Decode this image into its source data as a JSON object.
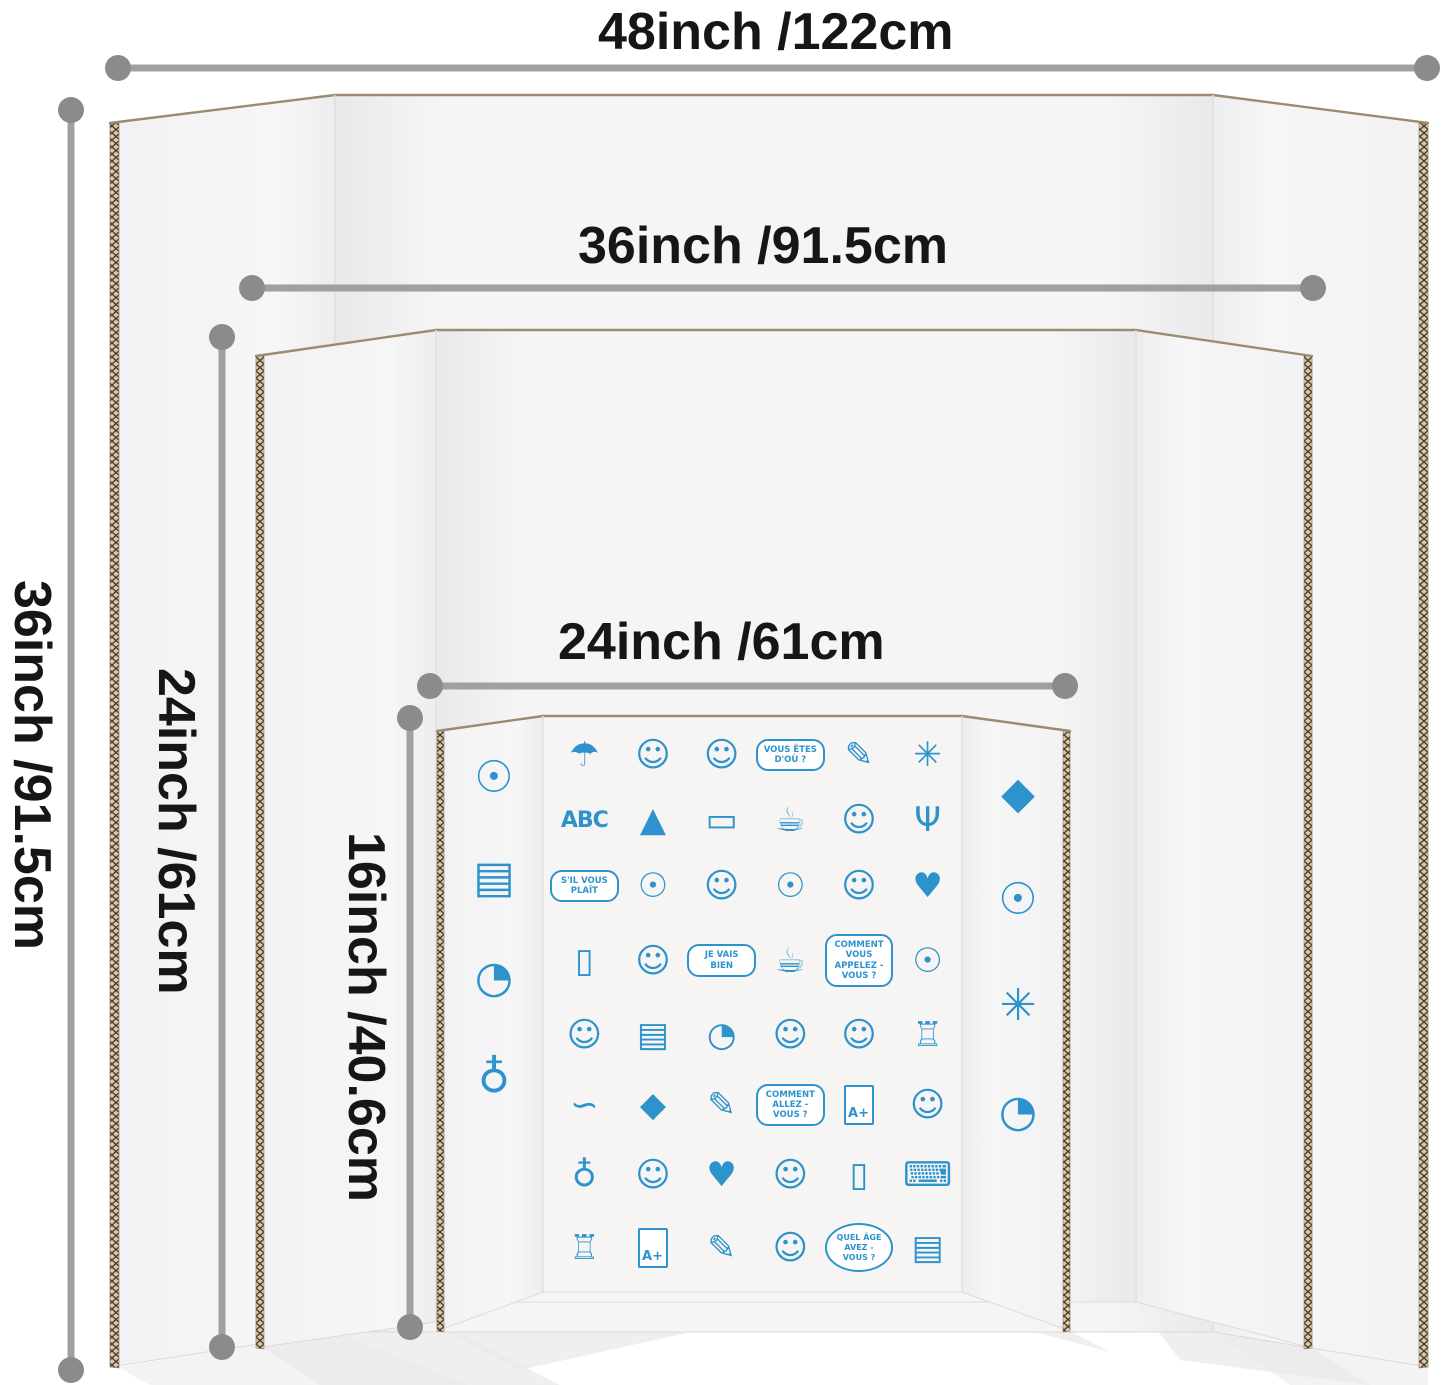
{
  "figure": {
    "type": "product-size-diagram",
    "subject": "tri-fold cardboard presentation display boards in three sizes"
  },
  "colors": {
    "dimension_line": "#a0a0a0",
    "dimension_dot": "#8b8b8b",
    "label_text": "#161616",
    "doodle_blue": "#2e93cc",
    "cardboard_edge": "#9c8b70",
    "corrug_bg": "#d9c9ab",
    "corrug_ink": "#46392b"
  },
  "dimensions": {
    "horizontal": [
      {
        "id": "width-48",
        "label": "48inch /122cm"
      },
      {
        "id": "width-36",
        "label": "36inch /91.5cm"
      },
      {
        "id": "width-24",
        "label": "24inch /61cm"
      }
    ],
    "vertical": [
      {
        "id": "height-36",
        "label": "36inch /91.5cm"
      },
      {
        "id": "height-24",
        "label": "24inch /61cm"
      },
      {
        "id": "height-16",
        "label": "16inch /40.6cm"
      }
    ]
  },
  "boards": [
    {
      "name": "large tri-fold board",
      "width_label": "48inch /122cm",
      "height_label": "36inch /91.5cm"
    },
    {
      "name": "medium tri-fold board",
      "width_label": "36inch /91.5cm",
      "height_label": "24inch /61cm"
    },
    {
      "name": "small tri-fold board with doodles",
      "width_label": "24inch /61cm",
      "height_label": "16inch /40.6cm"
    }
  ],
  "doodles": {
    "left_wing": [
      {
        "name": "light-bulb",
        "glyph": "☉"
      },
      {
        "name": "open-book",
        "glyph": "▤"
      },
      {
        "name": "alarm-clock-on-books",
        "glyph": "◔"
      },
      {
        "name": "desk-globe",
        "glyph": "♁"
      }
    ],
    "right_wing": [
      {
        "name": "graduation-cap",
        "glyph": "◆"
      },
      {
        "name": "brain-light-bulb",
        "glyph": "☉"
      },
      {
        "name": "windmill",
        "glyph": "✳"
      },
      {
        "name": "wall-clock",
        "glyph": "◔"
      }
    ],
    "center": [
      {
        "name": "sun-hat",
        "glyph": "☂"
      },
      {
        "name": "girl-with-bows",
        "glyph": "☺"
      },
      {
        "name": "girl",
        "glyph": "☺"
      },
      {
        "name": "speech-bubble",
        "type": "bubble",
        "text": "VOUS ÊTES D'OÙ ?"
      },
      {
        "name": "paintbrush",
        "glyph": "✎"
      },
      {
        "name": "windmill",
        "glyph": "✳"
      },
      {
        "name": "abc-blocks",
        "type": "text",
        "text": "ABC"
      },
      {
        "name": "cheese",
        "glyph": "▲"
      },
      {
        "name": "eraser",
        "glyph": "▭"
      },
      {
        "name": "coffee-cup",
        "glyph": "☕"
      },
      {
        "name": "girl",
        "glyph": "☺"
      },
      {
        "name": "wine-glass",
        "glyph": "Ψ"
      },
      {
        "name": "speech-bubble",
        "type": "bubble",
        "text": "S'IL VOUS PLAÎT"
      },
      {
        "name": "brain-light-bulb",
        "glyph": "☉"
      },
      {
        "name": "boy",
        "glyph": "☺"
      },
      {
        "name": "light-bulb",
        "glyph": "☉"
      },
      {
        "name": "dancing-girl",
        "glyph": "☺"
      },
      {
        "name": "heart",
        "glyph": "♥"
      },
      {
        "name": "jar",
        "glyph": "▯"
      },
      {
        "name": "boy",
        "glyph": "☺"
      },
      {
        "name": "speech-bubble",
        "type": "bubble",
        "text": "JE VAIS BIEN"
      },
      {
        "name": "teacup",
        "glyph": "☕"
      },
      {
        "name": "speech-bubble",
        "type": "bubble",
        "text": "COMMENT VOUS APPELEZ - VOUS ?"
      },
      {
        "name": "light-bulb",
        "glyph": "☉"
      },
      {
        "name": "boy",
        "glyph": "☺"
      },
      {
        "name": "open-book",
        "glyph": "▤"
      },
      {
        "name": "clock",
        "glyph": "◔"
      },
      {
        "name": "girl",
        "glyph": "☺"
      },
      {
        "name": "boy",
        "glyph": "☺"
      },
      {
        "name": "eiffel-tower",
        "glyph": "♖"
      },
      {
        "name": "baguette-bread",
        "glyph": "∽"
      },
      {
        "name": "graduation-cap",
        "glyph": "◆"
      },
      {
        "name": "paintbrush",
        "glyph": "✎"
      },
      {
        "name": "speech-bubble",
        "type": "bubble",
        "text": "COMMENT ALLEZ - VOUS ?"
      },
      {
        "name": "graded-paper",
        "type": "paper",
        "text": "A+"
      },
      {
        "name": "girl",
        "glyph": "☺"
      },
      {
        "name": "desk-globe",
        "glyph": "♁"
      },
      {
        "name": "boy-with-coffee",
        "glyph": "☺"
      },
      {
        "name": "heart",
        "glyph": "♥"
      },
      {
        "name": "boy",
        "glyph": "☺"
      },
      {
        "name": "bottle",
        "glyph": "▯"
      },
      {
        "name": "laptop-email",
        "glyph": "⌨"
      },
      {
        "name": "notre-dame-cathedral",
        "glyph": "♖"
      },
      {
        "name": "graded-paper",
        "type": "paper",
        "text": "A+"
      },
      {
        "name": "pencil",
        "glyph": "✎"
      },
      {
        "name": "ant-girl",
        "glyph": "☺"
      },
      {
        "name": "thought-cloud",
        "type": "cloud",
        "text": "QUEL ÂGE AVEZ - VOUS ?"
      },
      {
        "name": "book-stack",
        "glyph": "▤"
      }
    ]
  }
}
